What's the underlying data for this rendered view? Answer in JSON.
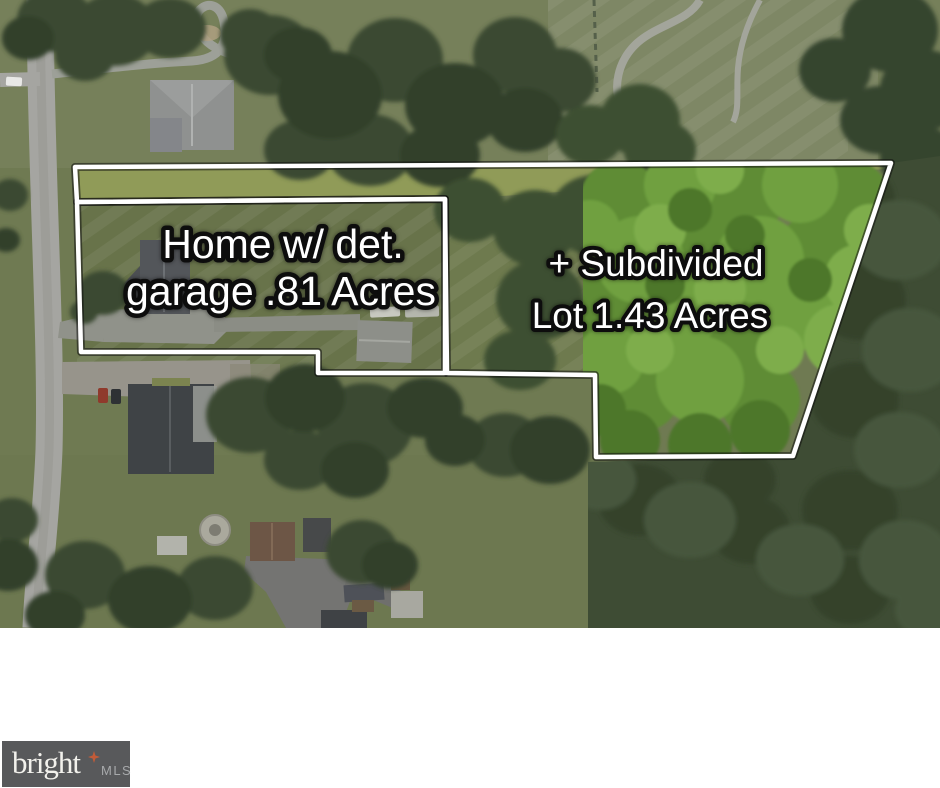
{
  "annotations": {
    "home_lot": {
      "line1": "Home w/ det.",
      "line2": "garage .81 Acres"
    },
    "subdivided_lot": {
      "line1": "+ Subdivided",
      "line2": "Lot 1.43 Acres"
    }
  },
  "watermark": {
    "brand": "bright",
    "suffix": "MLS"
  },
  "colors": {
    "boundary_line": "#ffffff",
    "boundary_outline": "#141414",
    "annotation_fill": "#ffffff",
    "annotation_outline": "#0d0d0d",
    "logo_background": "#58595b",
    "logo_brand_text": "#f2f1ec",
    "logo_star_accent": "#c25b38",
    "logo_suffix_text": "#a7a9ab"
  }
}
